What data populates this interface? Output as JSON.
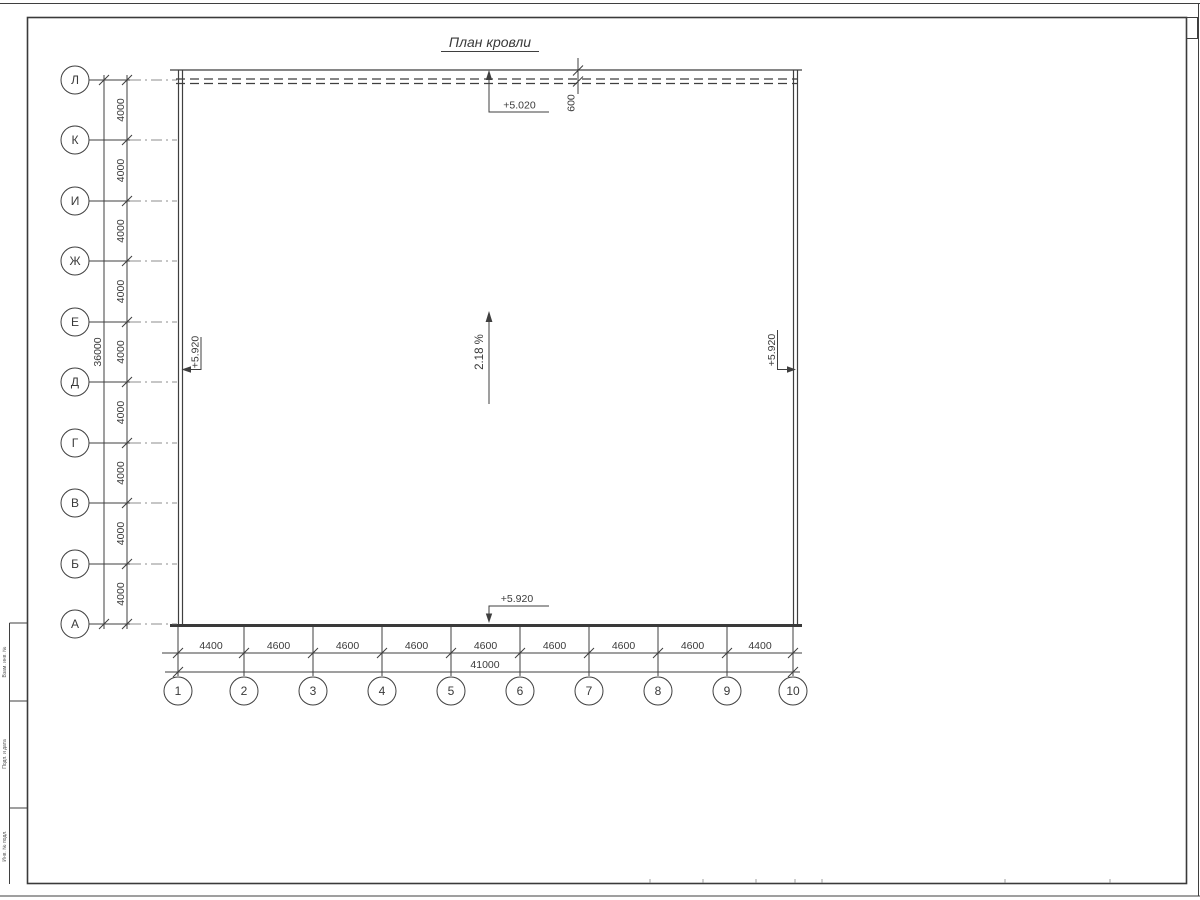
{
  "sheet": {
    "title": "План кровли"
  },
  "axes": {
    "rows": [
      "Л",
      "К",
      "И",
      "Ж",
      "Е",
      "Д",
      "Г",
      "В",
      "Б",
      "А"
    ],
    "cols": [
      "1",
      "2",
      "3",
      "4",
      "5",
      "6",
      "7",
      "8",
      "9",
      "10"
    ]
  },
  "dims": {
    "row_segments": [
      "4000",
      "4000",
      "4000",
      "4000",
      "4000",
      "4000",
      "4000",
      "4000",
      "4000"
    ],
    "row_total": "36000",
    "col_segments": [
      "4400",
      "4600",
      "4600",
      "4600",
      "4600",
      "4600",
      "4600",
      "4600",
      "4400"
    ],
    "col_total": "41000",
    "overhang": "600"
  },
  "marks": {
    "top": "+5.020",
    "left": "+5.920",
    "right": "+5.920",
    "bottom": "+5.920",
    "slope": "2.18 %"
  },
  "frame": {
    "side_labels": [
      "Взам. инв. №",
      "Подп. и дата",
      "Инв. № подл."
    ]
  },
  "colors": {
    "line": "#3f3f3f",
    "background": "#ffffff"
  }
}
